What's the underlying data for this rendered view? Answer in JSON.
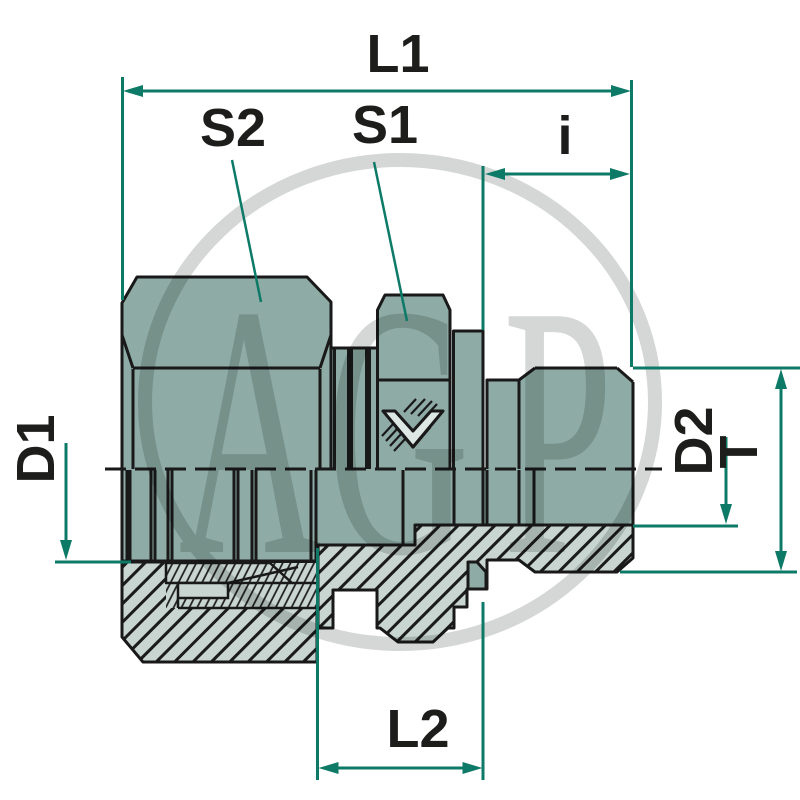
{
  "drawing": {
    "kind": "sectioned fitting dimension drawing",
    "labels": {
      "l1": "L1",
      "s2": "S2",
      "s1": "S1",
      "i": "i",
      "d1": "D1",
      "d2": "D2",
      "t": "T",
      "l2": "L2"
    },
    "watermark": {
      "letters": [
        "A",
        "G",
        "P"
      ]
    },
    "icons": {
      "seal_mark": "double-chevron-seal-icon"
    },
    "colors": {
      "body_fill": "#8EABA5",
      "section_fill": "#C8D5D1",
      "dimension_line": "#0D7A67",
      "outline": "#191919",
      "label_text": "#1D1D1B",
      "watermark": "#D4D7D6",
      "background": "#FFFFFF"
    }
  }
}
